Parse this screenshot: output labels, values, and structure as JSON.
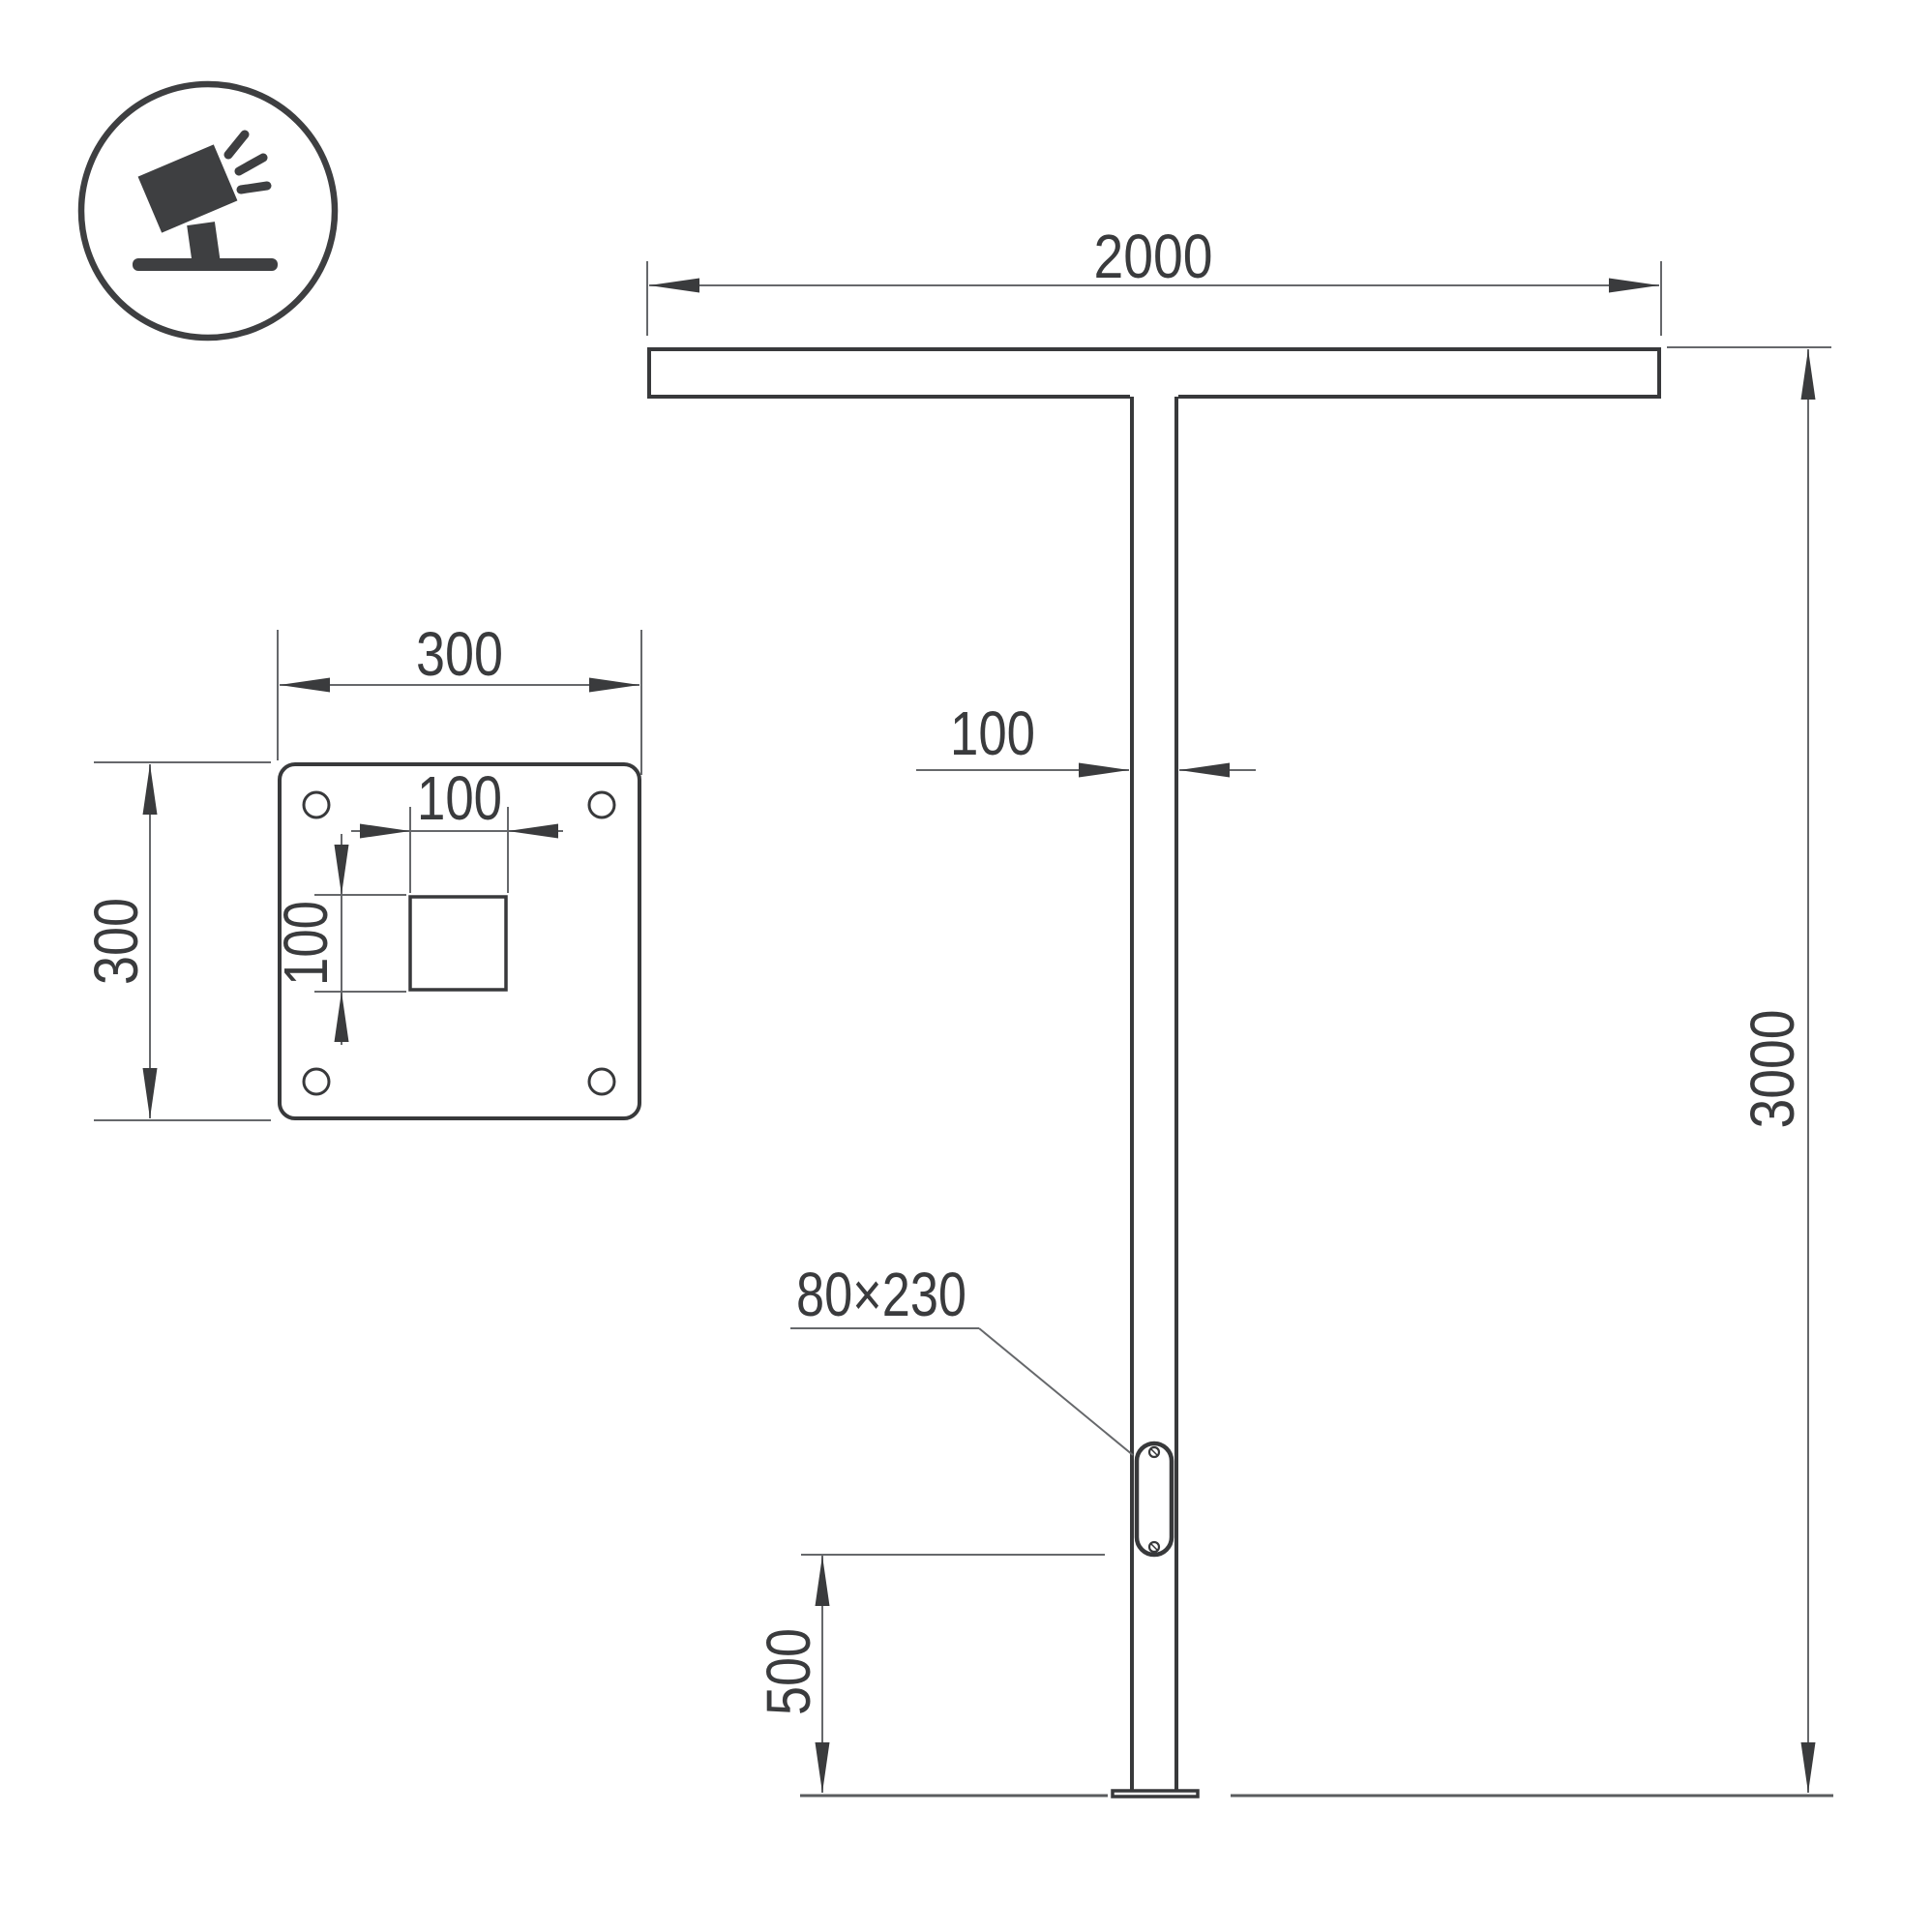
{
  "front_view": {
    "crossbar_length": "2000",
    "pole_height": "3000",
    "pole_width": "100",
    "door_bottom_offset": "500",
    "door_size": "80×230"
  },
  "base_plate_view": {
    "plate_width": "300",
    "plate_height": "300",
    "cutout_width": "100",
    "cutout_height": "100"
  },
  "icon": {
    "name": "tilted-floodlight-on-stand"
  },
  "colors": {
    "object_line": "#38393b",
    "dimension_line": "#66686b",
    "text": "#3a3b3d",
    "background": "#ffffff"
  }
}
